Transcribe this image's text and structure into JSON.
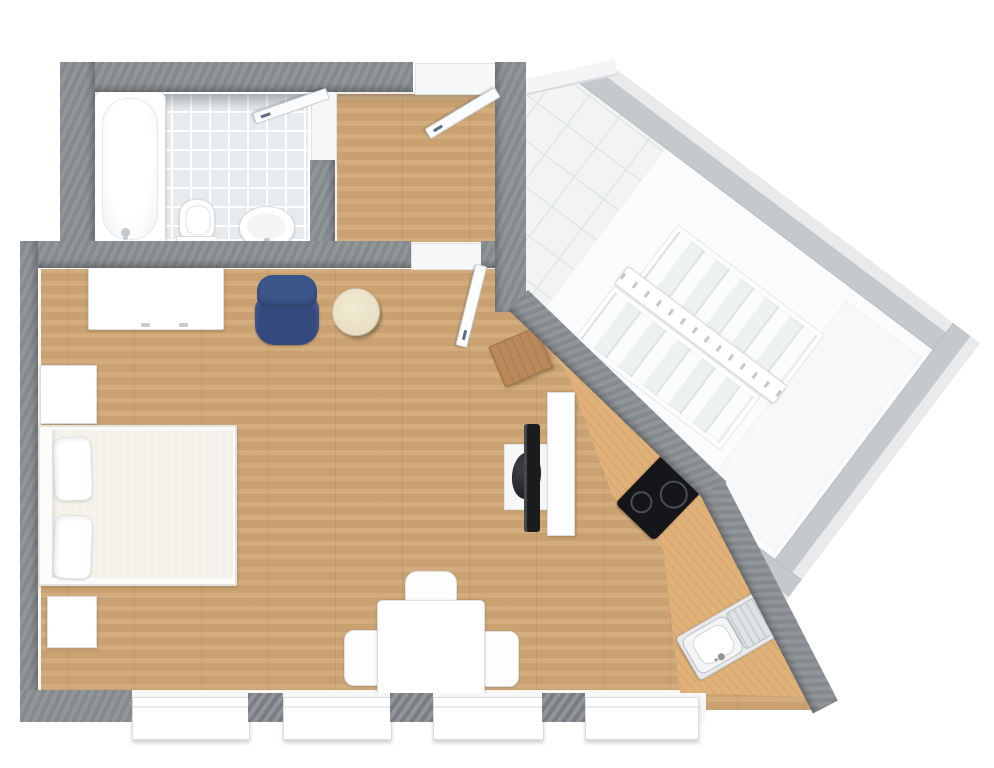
{
  "scene": {
    "kind": "3d-floor-plan",
    "width": 994,
    "height": 768,
    "background": "#ffffff"
  },
  "palette": {
    "wall_dark": "#8b9094",
    "wall_light": "#c6c9cc",
    "wall_light_face": "#e9eaeb",
    "wood_floor": "#d0a674",
    "wood_counter": "#e0b279",
    "wood_console": "#b9895a",
    "tile_bathroom": "#e7ebee",
    "tile_stairwell": "#f2f4f4",
    "fixture_white": "#ffffff",
    "chair_blue": "#34497e",
    "pouf_cream": "#ece3cc",
    "appliance_black": "#141619",
    "sink_steel": "#dfe3e5"
  },
  "rooms": {
    "bathroom": {
      "label": "Bathroom",
      "floor": "light gray tile",
      "fixtures": [
        "bathtub",
        "toilet",
        "pedestal sink"
      ],
      "doors": [
        "bathroom door"
      ]
    },
    "hallway": {
      "label": "Hallway",
      "floor": "wood",
      "doors": [
        "entry door",
        "living room door"
      ]
    },
    "living_room": {
      "label": "Living / Bedroom",
      "floor": "wood",
      "furniture": [
        "wardrobe dresser",
        "blue armchair",
        "round pouf",
        "double bed with two pillows",
        "nightstand",
        "nightstand",
        "square dining table",
        "dining chair",
        "dining chair",
        "dining chair",
        "TV bench",
        "TV",
        "lounge seat",
        "side panel"
      ]
    },
    "kitchen": {
      "label": "Kitchen",
      "floor": "wood",
      "features": [
        "corner console table",
        "angled wood counter",
        "two-burner cooktop",
        "stainless sink with drainboard"
      ]
    },
    "stairwell": {
      "label": "Stairwell",
      "floor": "white diagonal tile",
      "features": [
        "tiled landing",
        "upper stair flight",
        "lower stair flight",
        "center railing",
        "large landing"
      ]
    }
  },
  "windows": {
    "count": 4,
    "location": "bottom wall of living room"
  },
  "doors": {
    "entry": {
      "label": "Entry door",
      "state": "open"
    },
    "bathroom": {
      "label": "Bathroom door",
      "state": "open"
    },
    "living": {
      "label": "Living room door",
      "state": "open"
    }
  }
}
